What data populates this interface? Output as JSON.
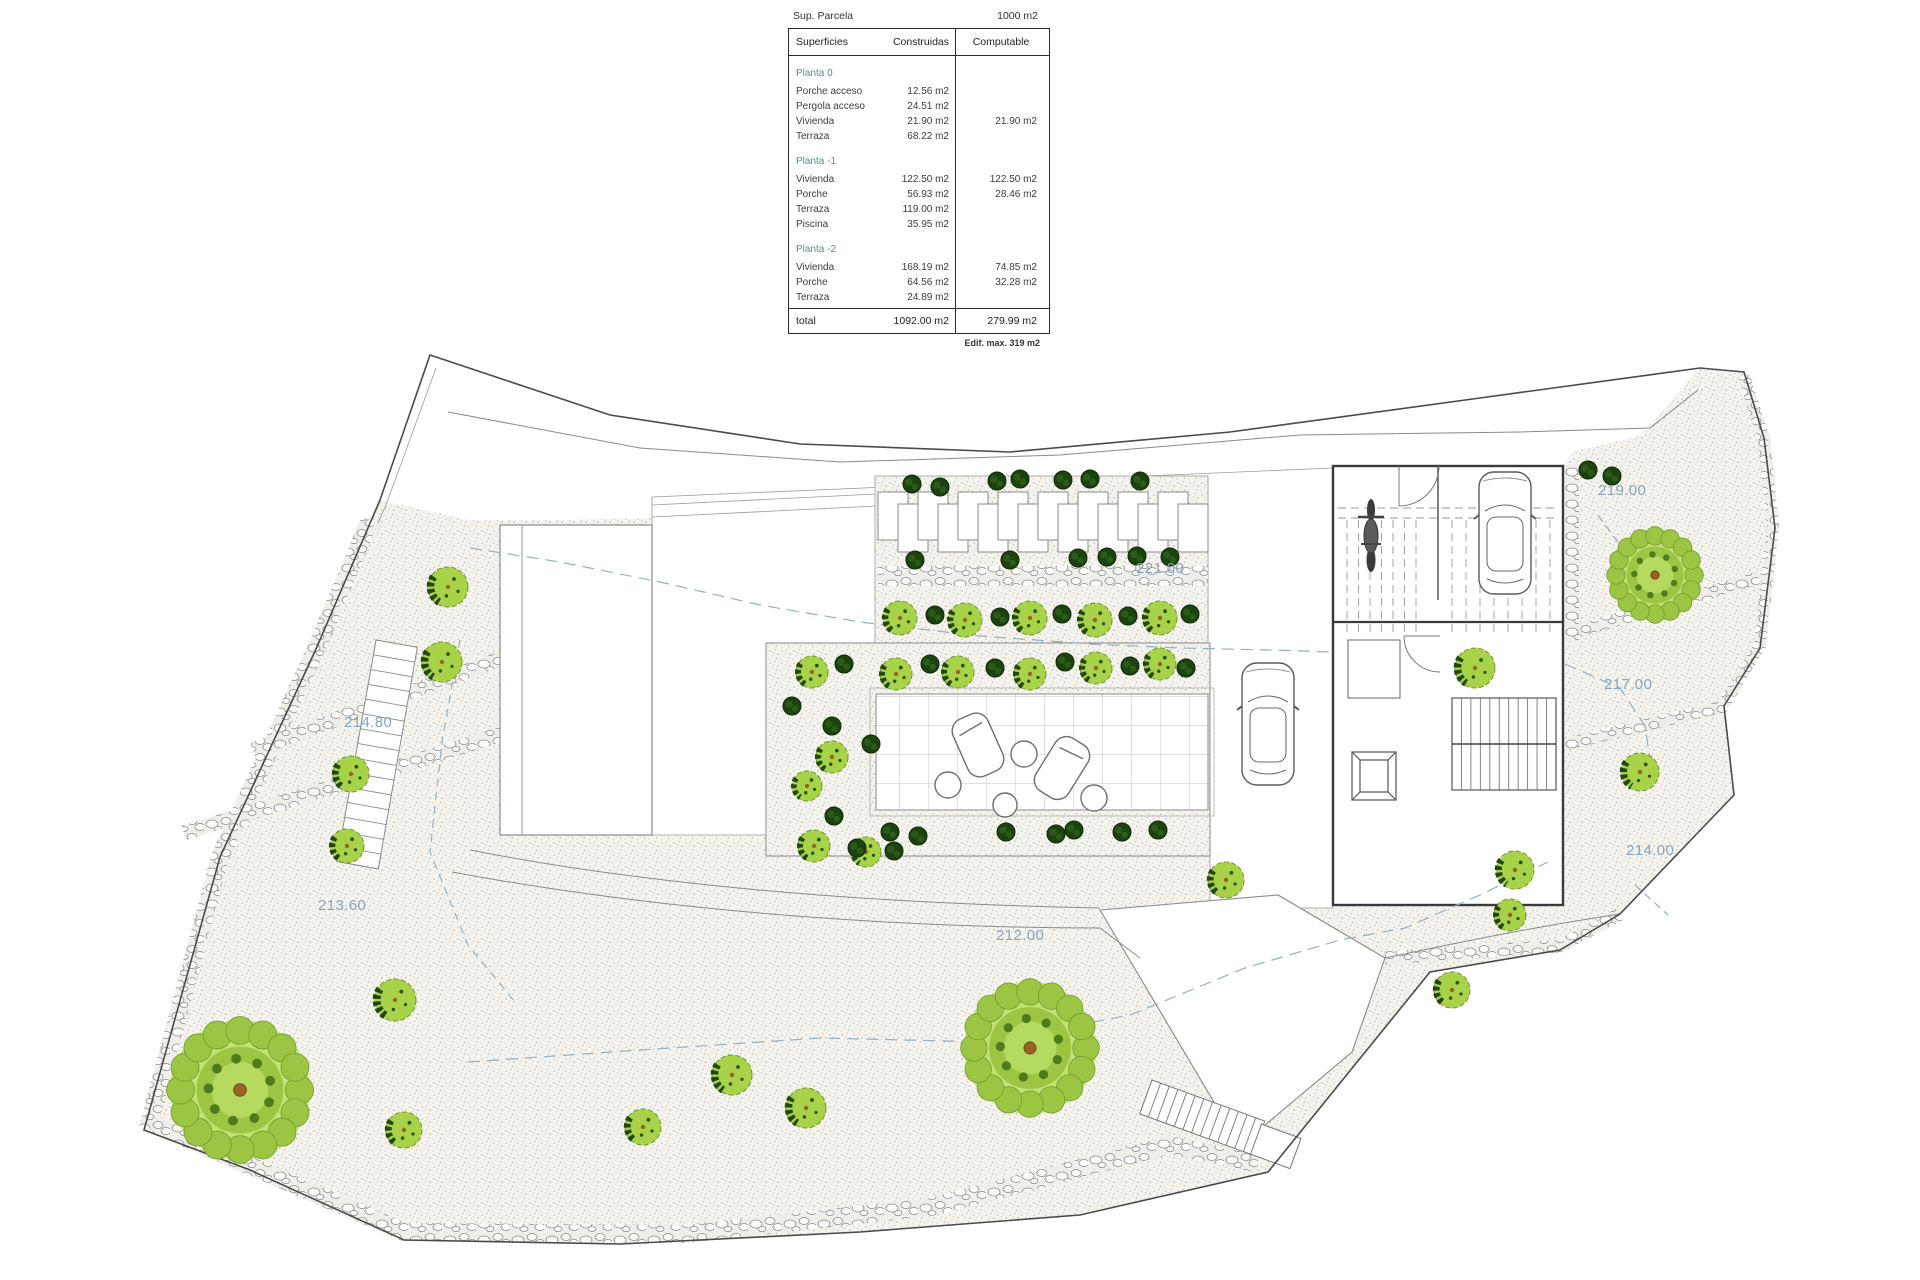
{
  "table": {
    "parcel_label": "Sup. Parcela",
    "parcel_value": "1000 m2",
    "col_superficies": "Superficies",
    "col_construidas": "Construidas",
    "col_computable": "Computable",
    "sections": [
      {
        "name": "Planta 0",
        "rows": [
          [
            "Porche acceso",
            "12.56 m2",
            ""
          ],
          [
            "Pergola acceso",
            "24.51 m2",
            ""
          ],
          [
            "Vivienda",
            "21.90 m2",
            "21.90 m2"
          ],
          [
            "Terraza",
            "68.22 m2",
            ""
          ]
        ]
      },
      {
        "name": "Planta -1",
        "rows": [
          [
            "Vivienda",
            "122.50 m2",
            "122.50 m2"
          ],
          [
            "Porche",
            "56.93 m2",
            "28.46 m2"
          ],
          [
            "Terraza",
            "119.00 m2",
            ""
          ],
          [
            "Piscina",
            "35.95 m2",
            ""
          ]
        ]
      },
      {
        "name": "Planta -2",
        "rows": [
          [
            "Vivienda",
            "168.19 m2",
            "74.85 m2"
          ],
          [
            "Porche",
            "64.56 m2",
            "32.28 m2"
          ],
          [
            "Terraza",
            "24.89 m2",
            ""
          ]
        ]
      }
    ],
    "total_label": "total",
    "total_construidas": "1092.00 m2",
    "total_computable": "279.99 m2",
    "footnote": "Edif. max. 319 m2"
  },
  "plan": {
    "elevations": [
      {
        "text": "219.00"
      },
      {
        "text": "221.00"
      },
      {
        "text": "217.00"
      },
      {
        "text": "214.80"
      },
      {
        "text": "214.00"
      },
      {
        "text": "213.60"
      },
      {
        "text": "212.00"
      }
    ]
  },
  "colors": {
    "elevation_text": "#84a5bf",
    "planta_heading": "#4e8f96",
    "tree_light": "#a8d348",
    "bush_dark": "#1c430f",
    "stipple_bg": "#f4f3ee",
    "boundary_line": "#4a4a4a"
  }
}
